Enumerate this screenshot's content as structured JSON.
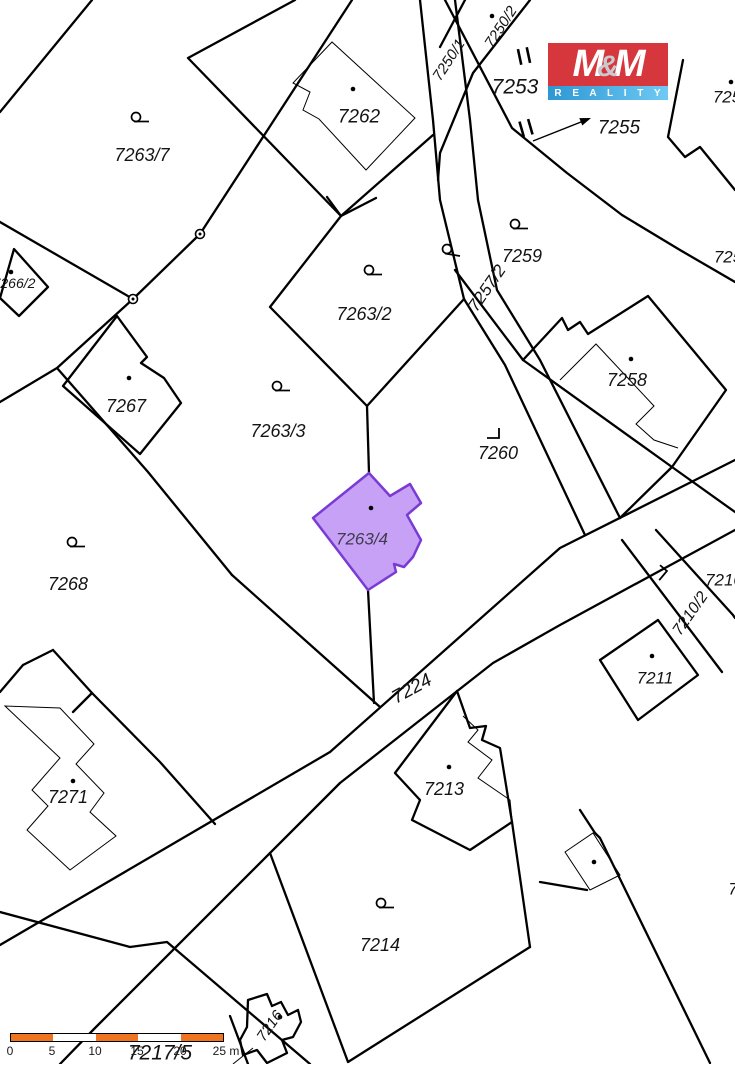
{
  "map": {
    "background": "#ffffff",
    "line_color": "#000000",
    "highlighted_parcel": {
      "number": "7263/4",
      "fill": "#c6a1f6",
      "border": "#7a3bd4",
      "label_color": "#3f3b4d"
    },
    "labels": [
      {
        "text": "7250/1"
      },
      {
        "text": "7250/2"
      },
      {
        "text": "7253"
      },
      {
        "text": "7255"
      },
      {
        "text": "725"
      },
      {
        "text": "7262"
      },
      {
        "text": "7263/7"
      },
      {
        "text": "725"
      },
      {
        "text": "7263/2"
      },
      {
        "text": "7257/2"
      },
      {
        "text": "7259"
      },
      {
        "text": "7266/2"
      },
      {
        "text": "7267"
      },
      {
        "text": "7263/3"
      },
      {
        "text": "7260"
      },
      {
        "text": "7258"
      },
      {
        "text": "7263/4"
      },
      {
        "text": "7268"
      },
      {
        "text": "7210"
      },
      {
        "text": "7210/2"
      },
      {
        "text": "7211"
      },
      {
        "text": "7224"
      },
      {
        "text": "7213"
      },
      {
        "text": "7271"
      },
      {
        "text": "7214"
      },
      {
        "text": "7216"
      },
      {
        "text": "7217/5"
      },
      {
        "text": "7"
      }
    ],
    "symbols": {
      "orchard": "circle-with-tail",
      "building_point": "black-dot",
      "boundary_marker": "small-ring",
      "land_use_corner": "l-corner-mark",
      "gate_mark": "double-stroke"
    }
  },
  "logo": {
    "m_left": "M",
    "ampersand": "&",
    "m_right": "M",
    "subtitle": "R E A L I T Y",
    "red": "#d6373c",
    "blue_start": "#2d97d3",
    "blue_end": "#6fc9f3"
  },
  "scale_bar": {
    "ticks": [
      "0",
      "5",
      "10",
      "15",
      "20",
      "25 m"
    ],
    "segment_color": "#ee7420",
    "length_label": "25 m"
  }
}
